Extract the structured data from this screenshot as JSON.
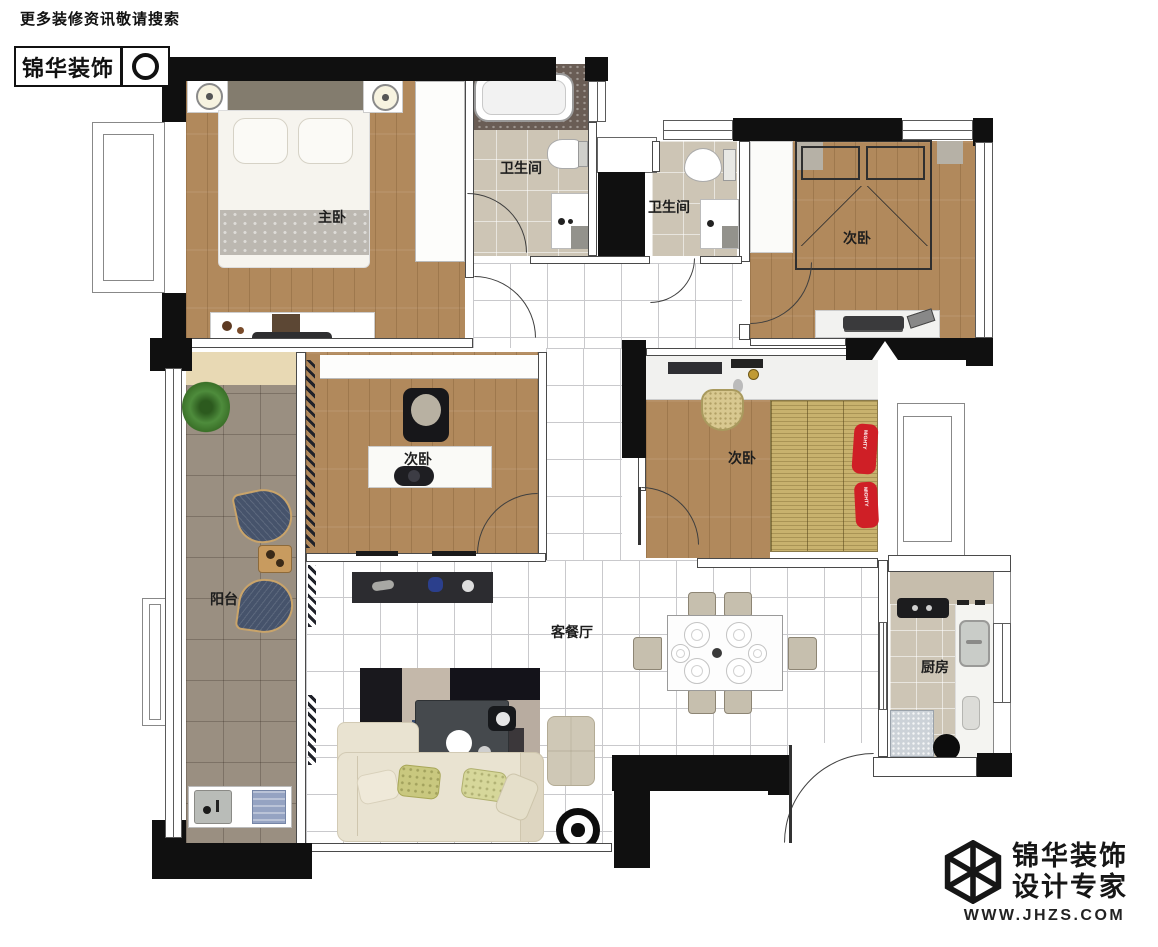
{
  "branding": {
    "top": {
      "tagline": "更多装修资讯敬请搜索",
      "logo_text": "锦华装饰",
      "search_icon": "magnifier-circle-icon"
    },
    "bottom": {
      "company": "锦华装饰",
      "slogan": "设计专家",
      "website": "WWW.JHZS.COM",
      "logo_icon": "hexagon-cube-wireframe-icon"
    }
  },
  "floorplan": {
    "rooms": [
      {
        "id": "master-bedroom",
        "label": "主卧"
      },
      {
        "id": "bathroom-1",
        "label": "卫生间"
      },
      {
        "id": "bathroom-2",
        "label": "卫生间"
      },
      {
        "id": "bedroom-top-right",
        "label": "次卧"
      },
      {
        "id": "bedroom-mid-left",
        "label": "次卧"
      },
      {
        "id": "bedroom-mid-right",
        "label": "次卧"
      },
      {
        "id": "balcony",
        "label": "阳台"
      },
      {
        "id": "living-dining",
        "label": "客餐厅"
      },
      {
        "id": "kitchen",
        "label": "厨房"
      }
    ],
    "decor": {
      "pillow_text": "MIGHTY"
    },
    "colors": {
      "wall": "#101010",
      "wood": "#b1895c",
      "tile_bath": "#cdc5b5",
      "tile_balcony": "#9a8f81",
      "tile_living": "#ffffff",
      "grid_line": "#c9c9cc",
      "tatami": "#c8b26e",
      "granite": "#6a5d55",
      "sofa": "#e9e3d1",
      "accent_red": "#cf1f26",
      "chair_blue": "#46536b",
      "plant_green": "#4e8c3c",
      "counter": "#c6bdac",
      "fridge": "#ccd2d8"
    }
  }
}
